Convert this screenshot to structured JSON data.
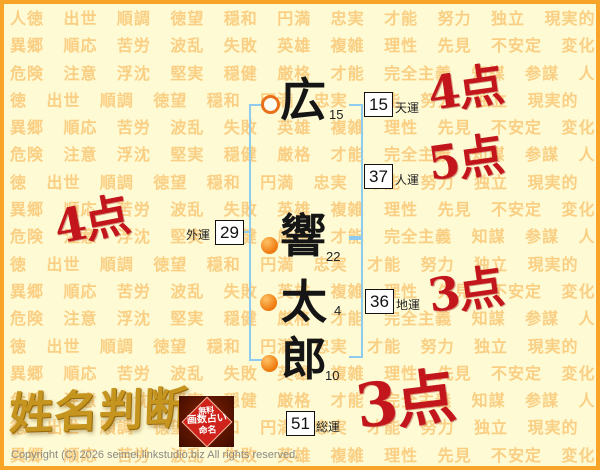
{
  "page": {
    "copyright": "Copyright (C) 2026 seimei.linkstudio.biz All rights reserved."
  },
  "background": {
    "repeat": 7,
    "words": [
      "人徳",
      "出世",
      "順調",
      "徳望",
      "穏和",
      "円満",
      "忠実",
      "才能",
      "努力",
      "独立",
      "現実的",
      "異郷",
      "順応",
      "苦労",
      "波乱",
      "失敗",
      "英雄",
      "複雑",
      "理性",
      "先見",
      "不安定",
      "変化",
      "危険",
      "注意",
      "浮沈",
      "堅実",
      "穏健",
      "厳格",
      "才能",
      "完全主義",
      "知謀",
      "参謀"
    ]
  },
  "logo": {
    "title": "姓名判断",
    "stamp_lines": [
      "無料",
      "画数占い",
      "命名"
    ]
  },
  "name": {
    "characters": [
      {
        "char": "広",
        "strokes": "15",
        "marker": "ring"
      },
      {
        "char": "響",
        "strokes": "22",
        "marker": "dot"
      },
      {
        "char": "太",
        "strokes": "4",
        "marker": "dot"
      },
      {
        "char": "郎",
        "strokes": "10",
        "marker": "dot"
      }
    ]
  },
  "fortunes": [
    {
      "id": "tenun",
      "value": "15",
      "label": "天運",
      "score": "4点"
    },
    {
      "id": "jinun",
      "value": "37",
      "label": "人運",
      "score": "5点"
    },
    {
      "id": "gaiun",
      "value": "29",
      "label": "外運",
      "score": "4点"
    },
    {
      "id": "chiun",
      "value": "36",
      "label": "地運",
      "score": "3点"
    },
    {
      "id": "soun",
      "value": "51",
      "label": "総運",
      "score": "3点"
    }
  ],
  "colors": {
    "border_orange": "#F7A428",
    "background_cream": "#FEFAD3",
    "watermark_orange": "#F6B350",
    "bracket_blue": "#8FCBEE",
    "marker_orange": "#EF7D12",
    "score_red": "#C3161C",
    "logo_gold": "#C6951F",
    "stamp_red": "#CE221A"
  }
}
